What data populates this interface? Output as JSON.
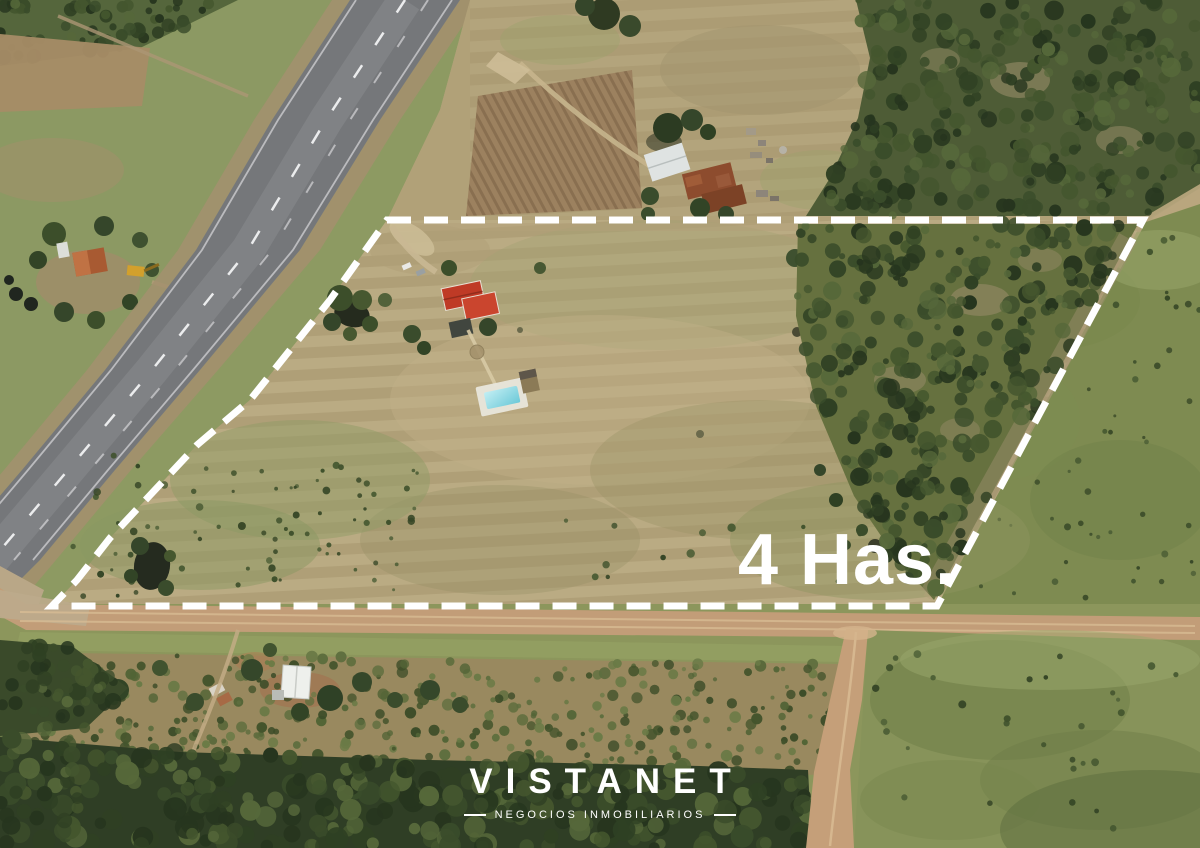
{
  "photo": {
    "area_label": "4 Has."
  },
  "brand": {
    "name": "VISTANET",
    "tagline": "NEGOCIOS INMOBILIARIOS"
  },
  "colors": {
    "boundary_dash": "#ffffff",
    "overlay_text": "#ffffff"
  }
}
